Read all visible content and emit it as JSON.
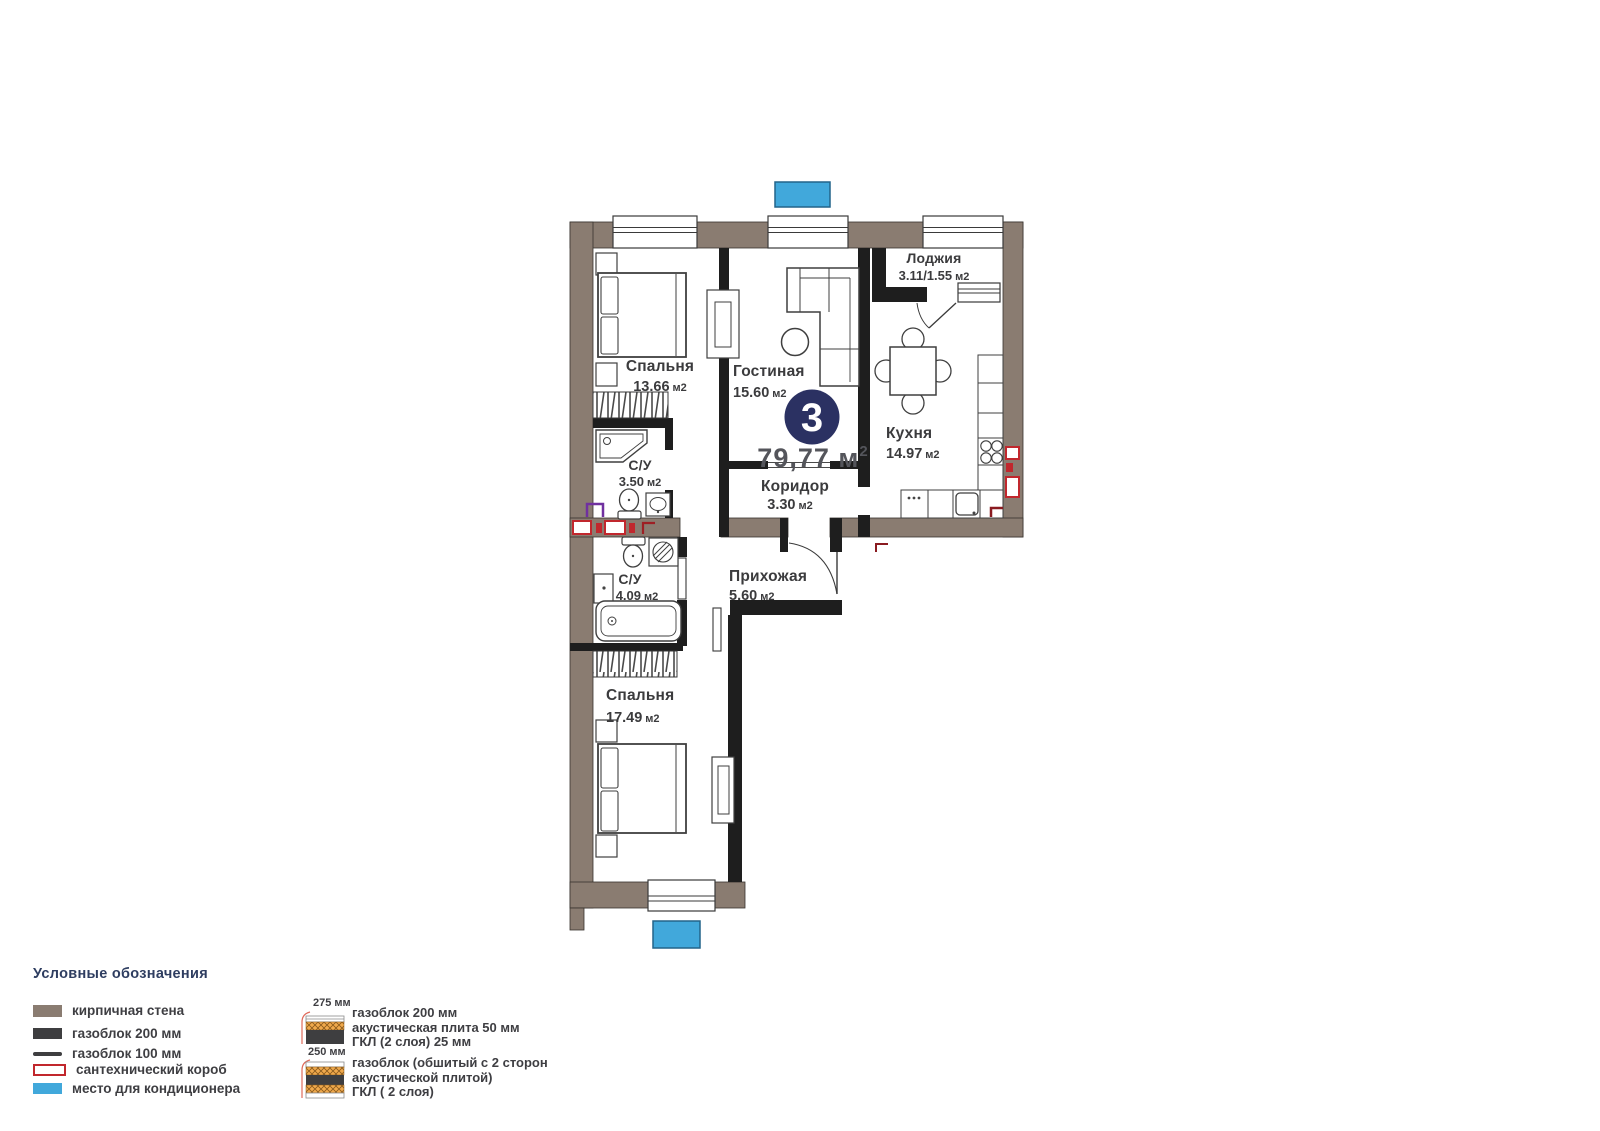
{
  "plan": {
    "badge": {
      "number": "3",
      "area_main": "79,77 м",
      "area_sup": "2"
    },
    "rooms": {
      "bedroom1": {
        "name": "Спальня",
        "value": "13.66",
        "unit": "м2"
      },
      "living": {
        "name": "Гостиная",
        "value": "15.60",
        "unit": "м2"
      },
      "loggia": {
        "name": "Лоджия",
        "value": "3.11/1.55",
        "unit": "м2"
      },
      "kitchen": {
        "name": "Кухня",
        "value": "14.97",
        "unit": "м2"
      },
      "bath_small": {
        "name": "С/У",
        "value": "3.50",
        "unit": "м2"
      },
      "corridor": {
        "name": "Коридор",
        "value": "3.30",
        "unit": "м2"
      },
      "bath_big": {
        "name": "С/У",
        "value": "4.09",
        "unit": "м2"
      },
      "hall": {
        "name": "Прихожая",
        "value": "5.60",
        "unit": "м2"
      },
      "bedroom2": {
        "name": "Спальня",
        "value": "17.49",
        "unit": "м2"
      }
    }
  },
  "legend": {
    "title": "Условные обозначения",
    "items": [
      {
        "label": "кирпичная стена",
        "swatch": "brick-wall-swatch"
      },
      {
        "label": "газоблок 200 мм",
        "swatch": "gasblock-200-swatch"
      },
      {
        "label": "газоблок 100 мм",
        "swatch": "gasblock-100-swatch"
      },
      {
        "label": "сантехнический короб",
        "swatch": "plumbing-box-swatch"
      },
      {
        "label": "место для кондиционера",
        "swatch": "ac-place-swatch"
      }
    ],
    "wall_types": [
      {
        "size": "275 мм",
        "line1": "газоблок 200 мм",
        "line2": "акустическая плита 50 мм",
        "line3": "ГКЛ (2 слоя) 25 мм"
      },
      {
        "size": "250 мм",
        "line1": "газоблок (обшитый с 2 сторон",
        "line2": "акустической плитой)",
        "line3": "ГКЛ ( 2 слоя)"
      }
    ]
  },
  "colors": {
    "brick_wall": "#8A7C71",
    "gas_block": "#1E1E1E",
    "ac_blue": "#41A8DB",
    "plumbing_red": "#C1272D",
    "badge_navy": "#2B3162",
    "accent_purple": "#7030A0",
    "legend_title": "#2E3D60",
    "total_area_text": "#54555B",
    "acoustic_orange": "#F0A94C"
  }
}
